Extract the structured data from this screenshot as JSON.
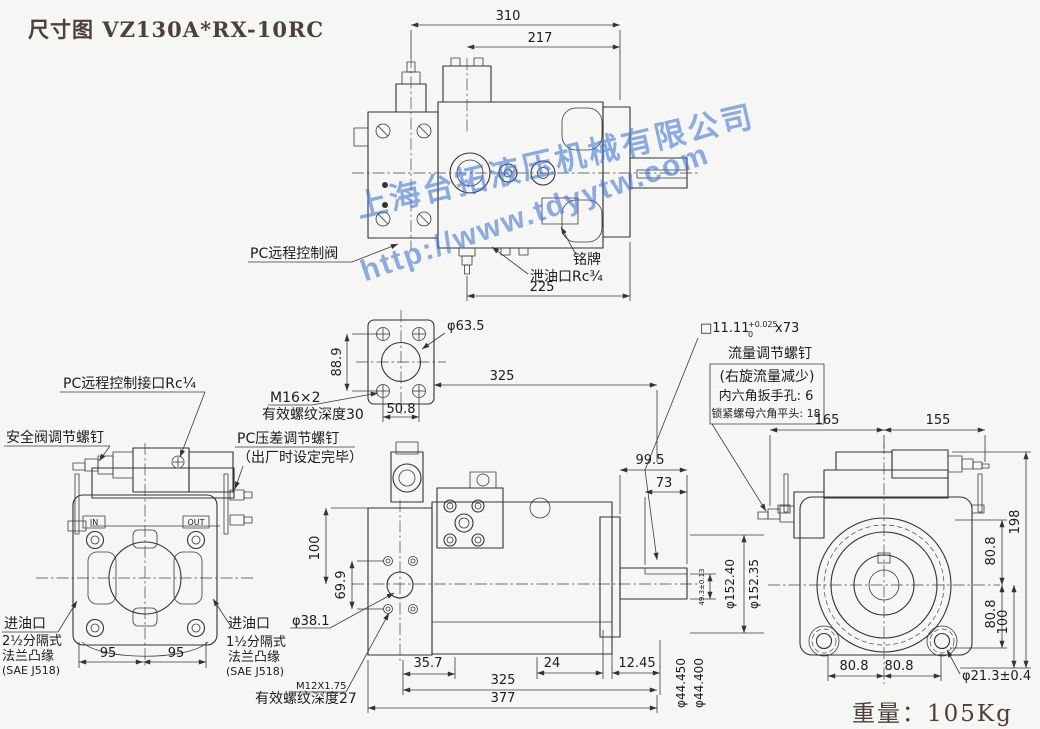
{
  "title": "尺寸图 VZ130A*RX-10RC",
  "watermark": {
    "company": "上海台拓液压机械有限公司",
    "url": "http://www.tdyytw.com"
  },
  "weight": "重量：105Kg",
  "top_view": {
    "d310": "310",
    "d217": "217",
    "d225": "225",
    "pc_remote_valve": "PC远程控制阀",
    "nameplate": "铭牌",
    "drain_port": "泄油口Rc¾"
  },
  "flange_detail": {
    "dia": "φ63.5",
    "d889": "88.9",
    "d508": "50.8",
    "thread": "M16×2",
    "thread_depth": "有效螺纹深度30",
    "d325": "325"
  },
  "key_spec": {
    "square": "□11.11",
    "tol_upper": "+0.025",
    "tol_lower": "0",
    "length": "x73",
    "screw": "流量调节螺钉",
    "note1": "(右旋流量减少)",
    "note2": "内六角扳手孔: 6",
    "note3": "锁紧螺母六角平头: 18"
  },
  "front_view": {
    "relief_screw": "安全阀调节螺钉",
    "pc_remote_port": "PC远程控制接口Rc¼",
    "inlet_left": [
      "进油口",
      "2½分隔式",
      "法兰凸缘",
      "(SAE J518)"
    ],
    "inlet_right": [
      "进油口",
      "1½分隔式",
      "法兰凸缘",
      "(SAE J518)"
    ],
    "d95a": "95",
    "d95b": "95",
    "port_in": "IN",
    "port_out": "OUT"
  },
  "side_view": {
    "pc_comp1": "PC压差调节螺钉",
    "pc_comp2": "（出厂时设定完毕）",
    "d100": "100",
    "d699": "69.9",
    "dia381": "φ38.1",
    "thread": "M12X1.75",
    "thread_depth": "有效螺纹深度27",
    "d357": "35.7",
    "d24": "24",
    "d1245": "12.45",
    "d325": "325",
    "d377": "377",
    "d995": "99.5",
    "d73": "73",
    "key_height": "49.3±0.13",
    "dia_spigot1": "φ152.40",
    "dia_spigot2": "φ152.35",
    "shaft_dia1": "φ44.450",
    "shaft_dia2": "φ44.400"
  },
  "rear_view": {
    "d165": "165",
    "d155": "155",
    "d198": "198",
    "d808_top": "80.8",
    "d808_mid": "80.8",
    "d100": "100",
    "d808_bl": "80.8",
    "d808_br": "80.8",
    "foot_hole": "φ21.3±0.4"
  }
}
